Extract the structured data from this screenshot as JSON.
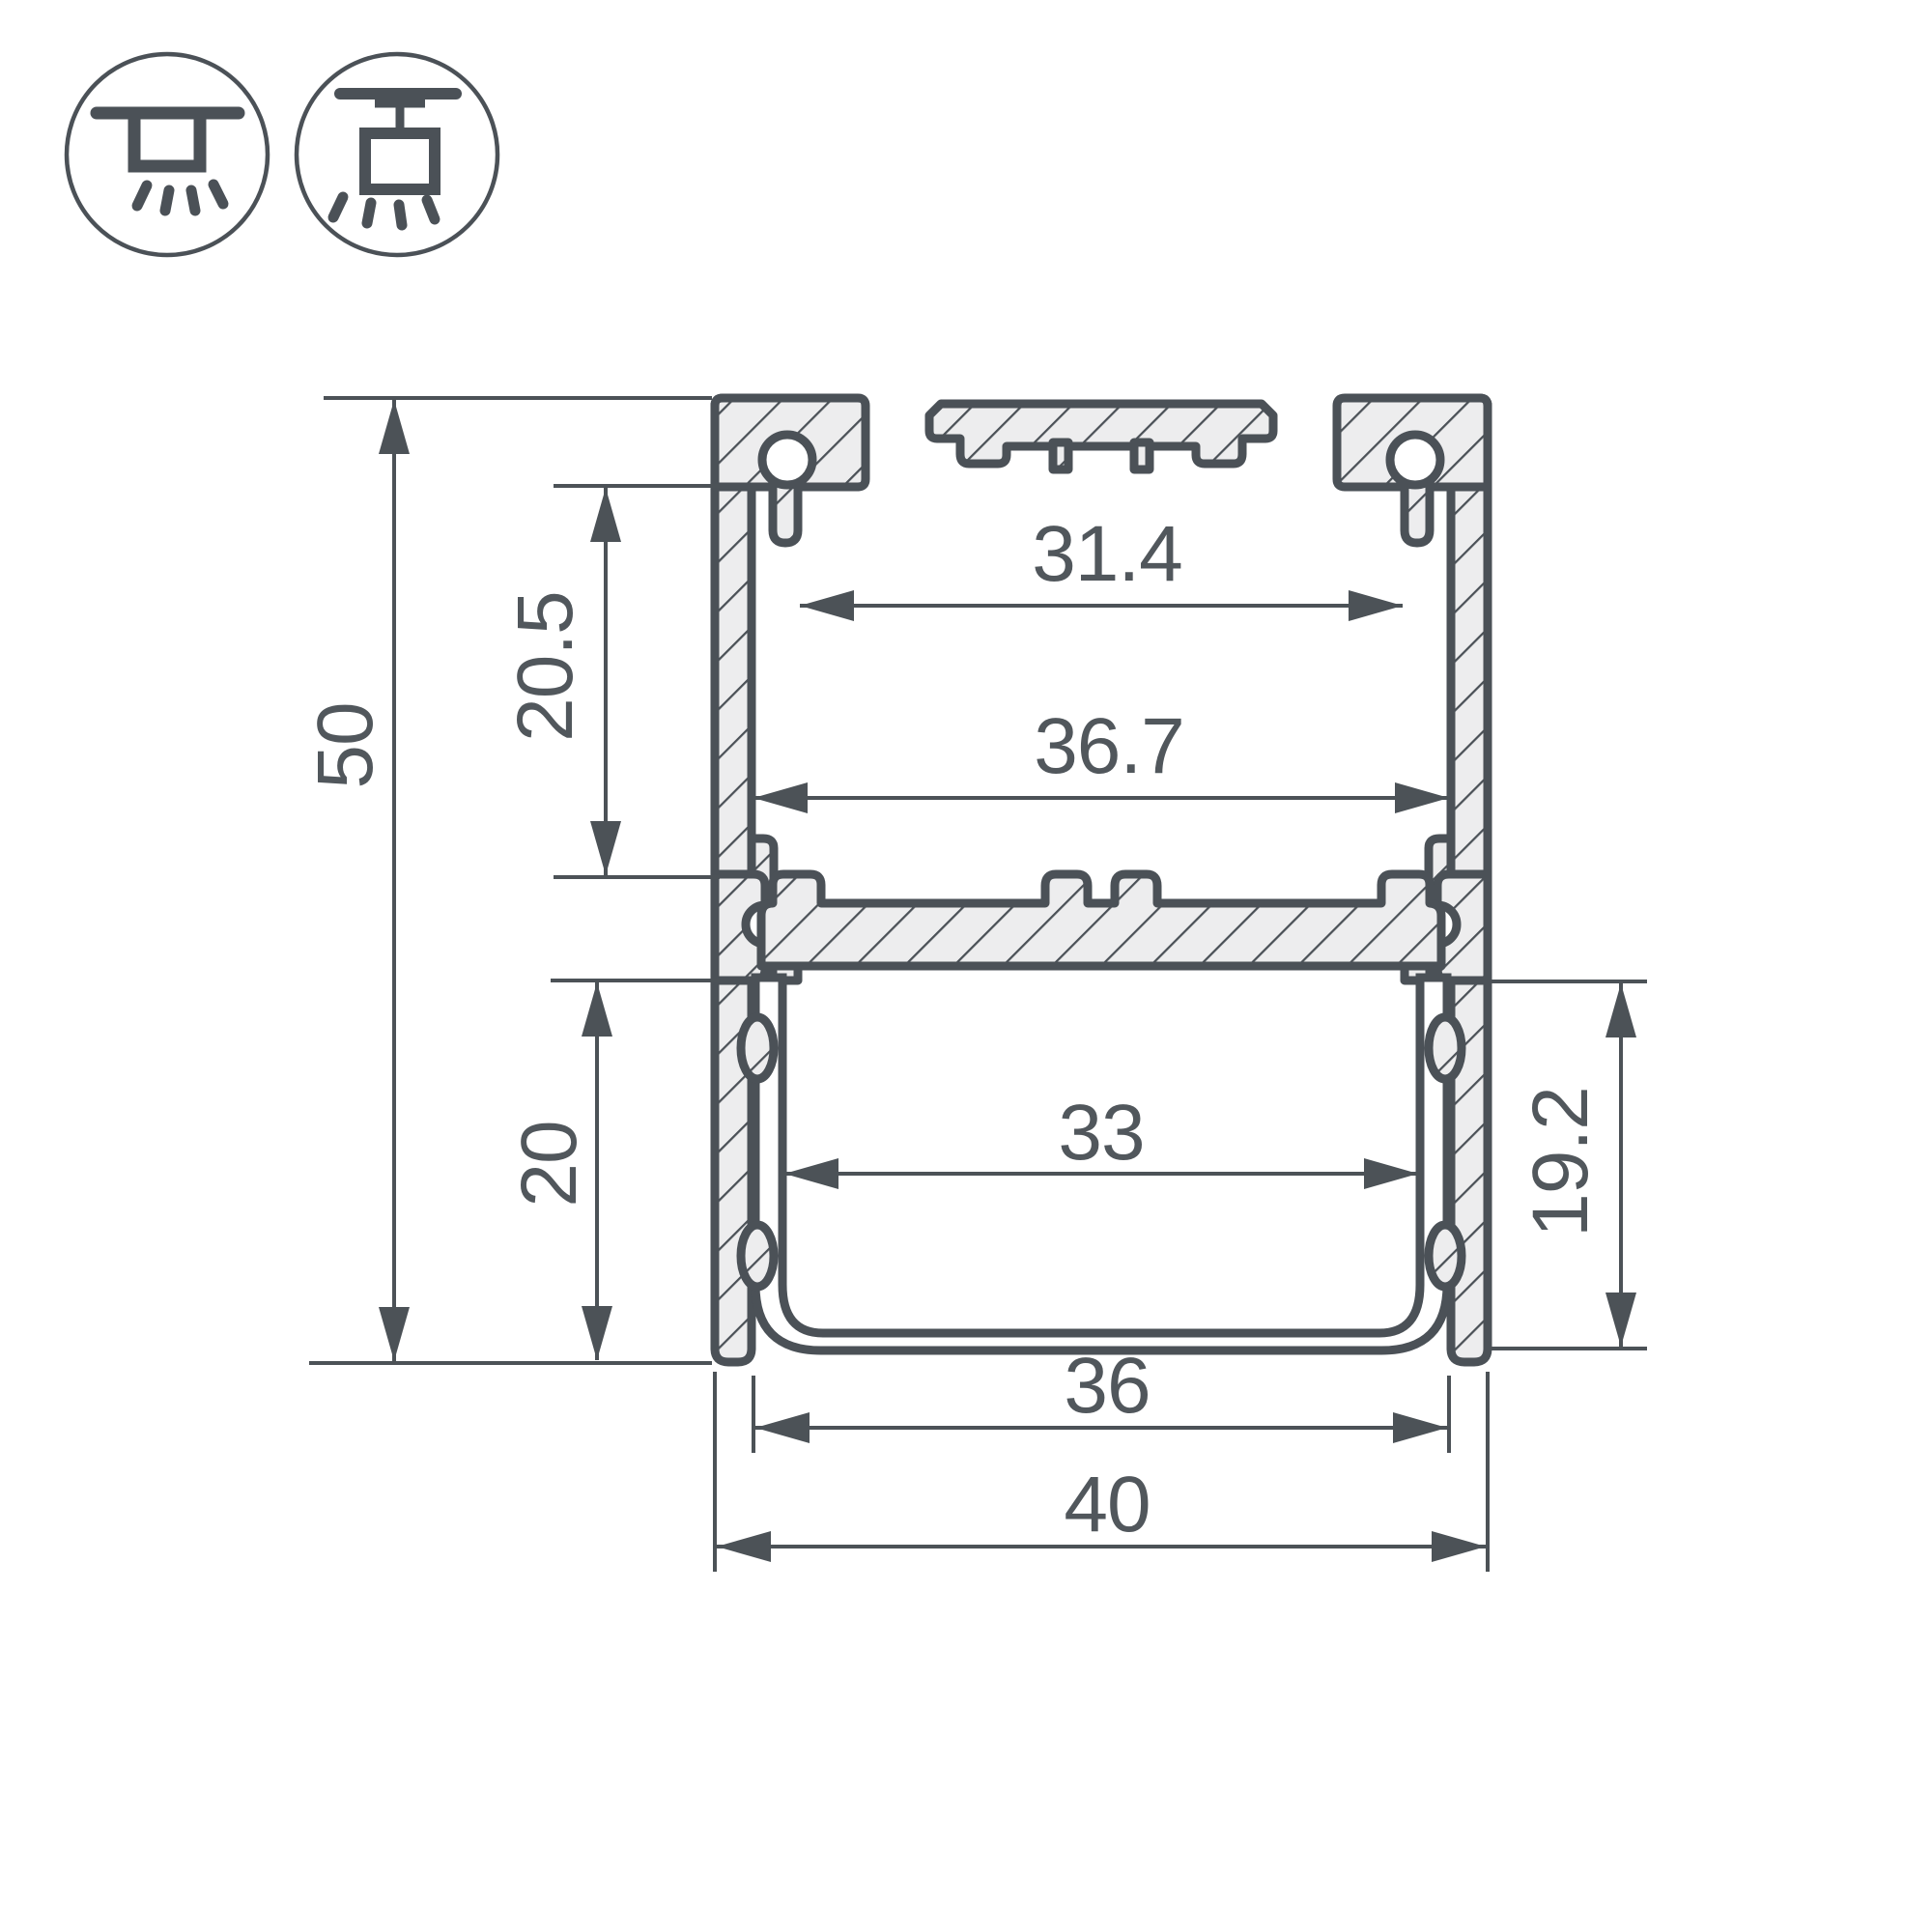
{
  "drawing": {
    "type": "profile-cross-section",
    "units": "mm",
    "dimensions": {
      "overall_height": "50",
      "overall_width": "40",
      "top_opening_width": "31.4",
      "inner_width_top": "36.7",
      "top_chamber_height": "20.5",
      "bottom_chamber_height": "20",
      "bottom_inner_width": "33",
      "side_inner_height": "19.2",
      "bottom_opening_width": "36"
    },
    "icons": [
      {
        "name": "surface-ceiling-mount-icon"
      },
      {
        "name": "pendant-ceiling-mount-icon"
      }
    ],
    "colors": {
      "line": "#4b5157",
      "metal_fill": "#ededee",
      "background": "#ffffff"
    }
  }
}
